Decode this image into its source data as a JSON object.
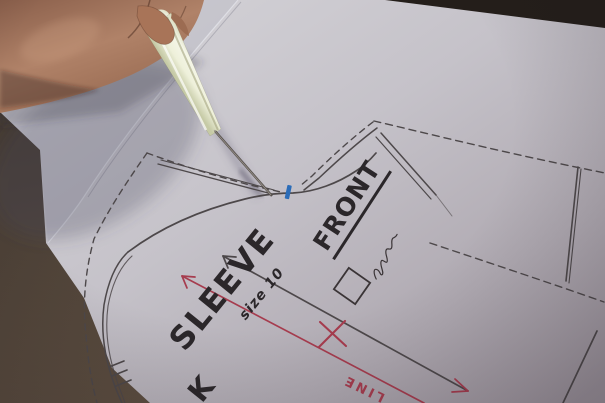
{
  "scene": {
    "type": "photograph",
    "subject": "Hand using a tracing awl on hand-drawn sewing pattern pieces laid on paper",
    "labels": {
      "piece_name": "SLEEVE",
      "piece_size": "size 10",
      "adjacent_piece": "FRONT",
      "grain_text": "LINE",
      "cut_off_letter": "K"
    },
    "colors": {
      "table_surface": "#3e3630",
      "paper": "#c5c2c9",
      "pattern_ink": "#4d484a",
      "marking_red": "#a63c4e",
      "notch_blue": "#2b6cb8",
      "tool_handle": "#eef0da",
      "skin": "#b08268"
    },
    "objects": [
      "hand",
      "tracing-awl",
      "pattern-paper",
      "sleeve-pattern-piece",
      "front-pattern-piece",
      "blue-notch-mark",
      "black-grain-arrow",
      "red-grain-arrow",
      "red-x-mark",
      "checkbox-square",
      "signature-scribble"
    ]
  }
}
